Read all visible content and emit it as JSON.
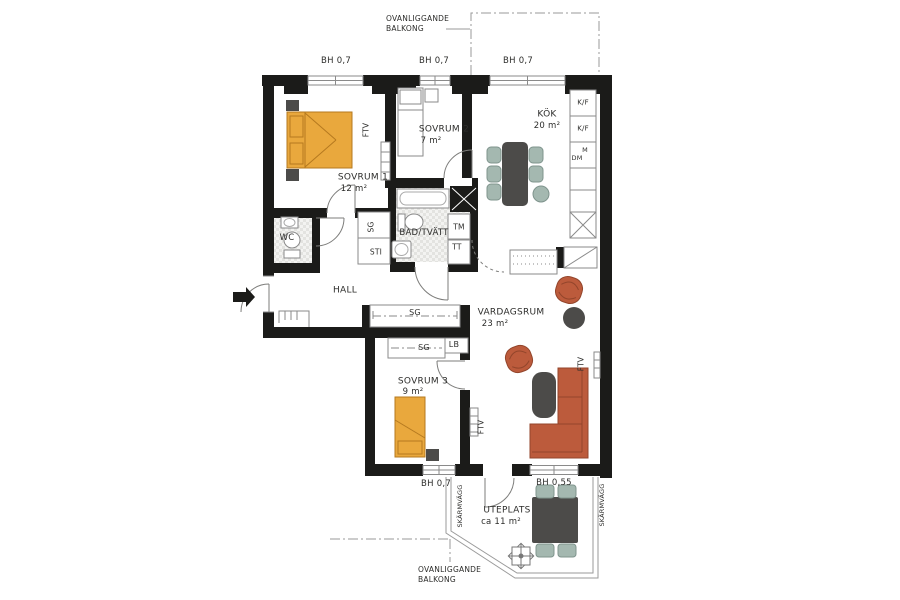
{
  "rooms": {
    "sovrum1": {
      "name": "SOVRUM 1",
      "area": "12 m²"
    },
    "sovrum2": {
      "name": "SOVRUM 2",
      "area": "7 m²"
    },
    "sovrum3": {
      "name": "SOVRUM 3",
      "area": "9 m²"
    },
    "kok": {
      "name": "KÖK",
      "area": "20 m²"
    },
    "vardagsrum": {
      "name": "VARDAGSRUM",
      "area": "23 m²"
    },
    "hall": {
      "name": "HALL"
    },
    "wc": {
      "name": "WC"
    },
    "bad": {
      "name": "BAD/TVÄTT"
    },
    "uteplats": {
      "name": "UTEPLATS",
      "area": "ca 11 m²"
    }
  },
  "annotations": {
    "balcony_above": "OVANLIGGANDE BALKONG",
    "window_height_07": "BH 0,7",
    "window_height_055": "BH 0,55",
    "screen_wall": "SKÄRMVÄGG"
  },
  "fixtures": {
    "ftv": "FTV",
    "sg": "SG",
    "sti": "STI",
    "tm": "TM",
    "tt": "TT",
    "lb": "LB",
    "kf": "K/F",
    "m": "M",
    "dm": "DM"
  },
  "colors": {
    "wall": "#1b1b19",
    "bed": "#e9a83d",
    "sofa": "#bc5b3c",
    "dark_furniture": "#4c4b49",
    "chair": "#a4b8b0",
    "tile": "#e3e3e0",
    "outline": "#8a8a8a"
  }
}
